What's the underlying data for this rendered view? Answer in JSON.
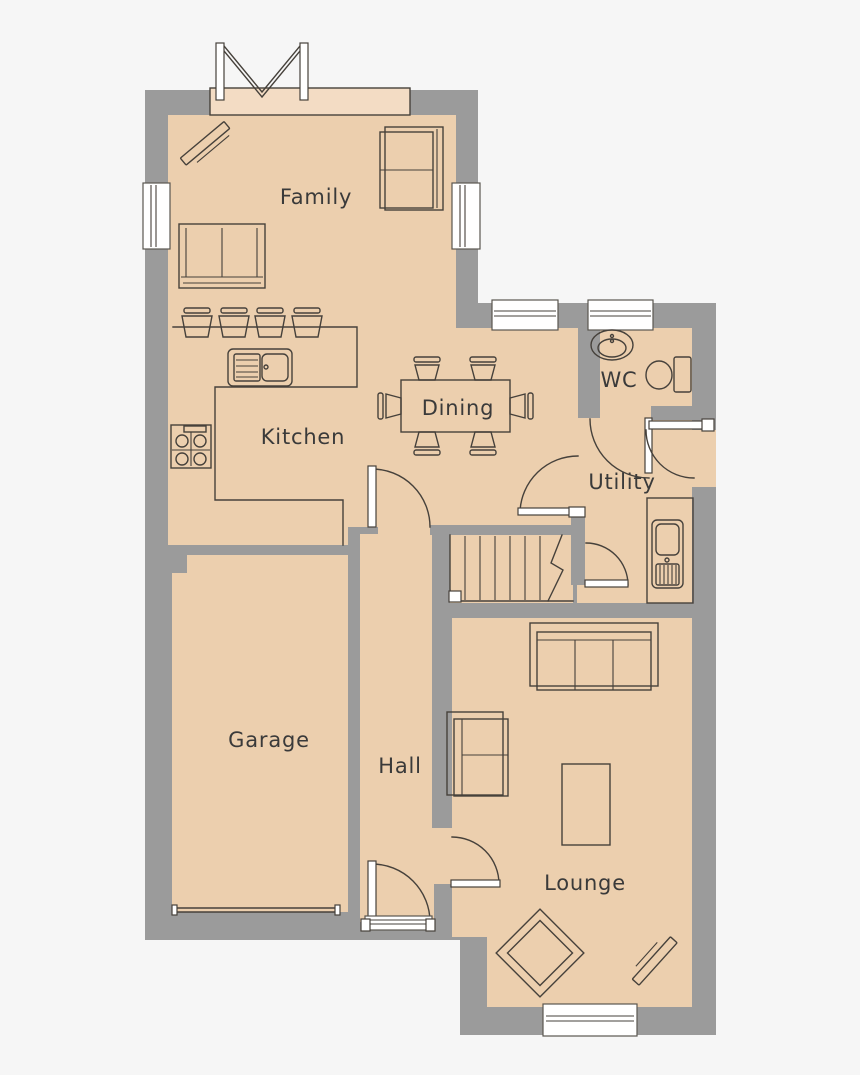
{
  "plan": {
    "title": "ground-floor-plan",
    "rooms": [
      {
        "id": "family",
        "label": "Family"
      },
      {
        "id": "kitchen",
        "label": "Kitchen"
      },
      {
        "id": "dining",
        "label": "Dining"
      },
      {
        "id": "wc",
        "label": "WC"
      },
      {
        "id": "utility",
        "label": "Utility"
      },
      {
        "id": "garage",
        "label": "Garage"
      },
      {
        "id": "hall",
        "label": "Hall"
      },
      {
        "id": "lounge",
        "label": "Lounge"
      }
    ],
    "fixtures": [
      "bifold-door",
      "corner-tv-unit",
      "two-seat-sofa",
      "wall-sofa",
      "breakfast-stools",
      "kitchen-sink",
      "hob",
      "dining-table",
      "dining-chairs",
      "wash-basin",
      "toilet",
      "utility-sink",
      "stairs",
      "three-seat-sofa",
      "loveseat",
      "coffee-table",
      "corner-armchair",
      "lounge-tv-unit",
      "windows",
      "door-arcs",
      "garage-door",
      "front-door"
    ],
    "colors": {
      "wall": "#9b9b9b",
      "floor": "#eccfae",
      "floorlight": "#f3dcc4",
      "line": "#46413b",
      "text": "#3a3a3a",
      "bg": "#f6f6f6",
      "white": "#ffffff"
    }
  }
}
